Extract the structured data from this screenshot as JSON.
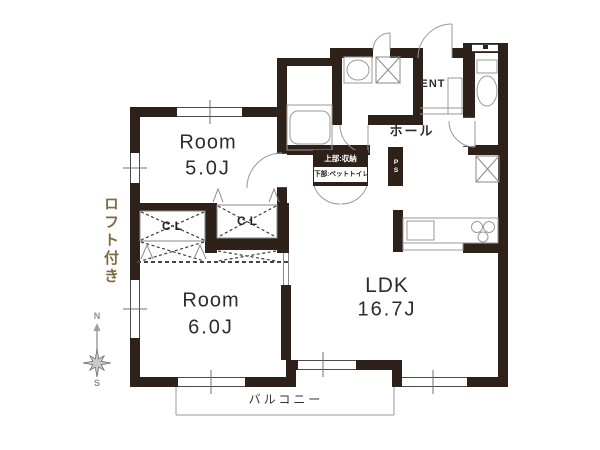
{
  "title": "apartment floor plan",
  "rooms": {
    "room5": {
      "name": "Room",
      "size": "5.0J"
    },
    "room6": {
      "name": "Room",
      "size": "6.0J"
    },
    "ldk": {
      "name": "LDK",
      "size": "16.7J"
    }
  },
  "closets": {
    "cl1": "CL",
    "cl2": "CL"
  },
  "hall_label": "ホール",
  "entrance_label": "ENT",
  "pipe_shaft_label": "PS",
  "storage_note": {
    "line1": "上部:収納",
    "line2": "下部:ペットトイレ"
  },
  "balcony_label": "バルコニー",
  "loft_label": "ロフト付き",
  "compass": {
    "north": "N",
    "south": "S"
  },
  "colors": {
    "wall": "#2e2119",
    "loft_text": "#7d6b42",
    "fixture_line": "#999999",
    "dashed_line": "#444444",
    "label_text": "#2d2d2d",
    "compass": "#9e9e9e"
  }
}
